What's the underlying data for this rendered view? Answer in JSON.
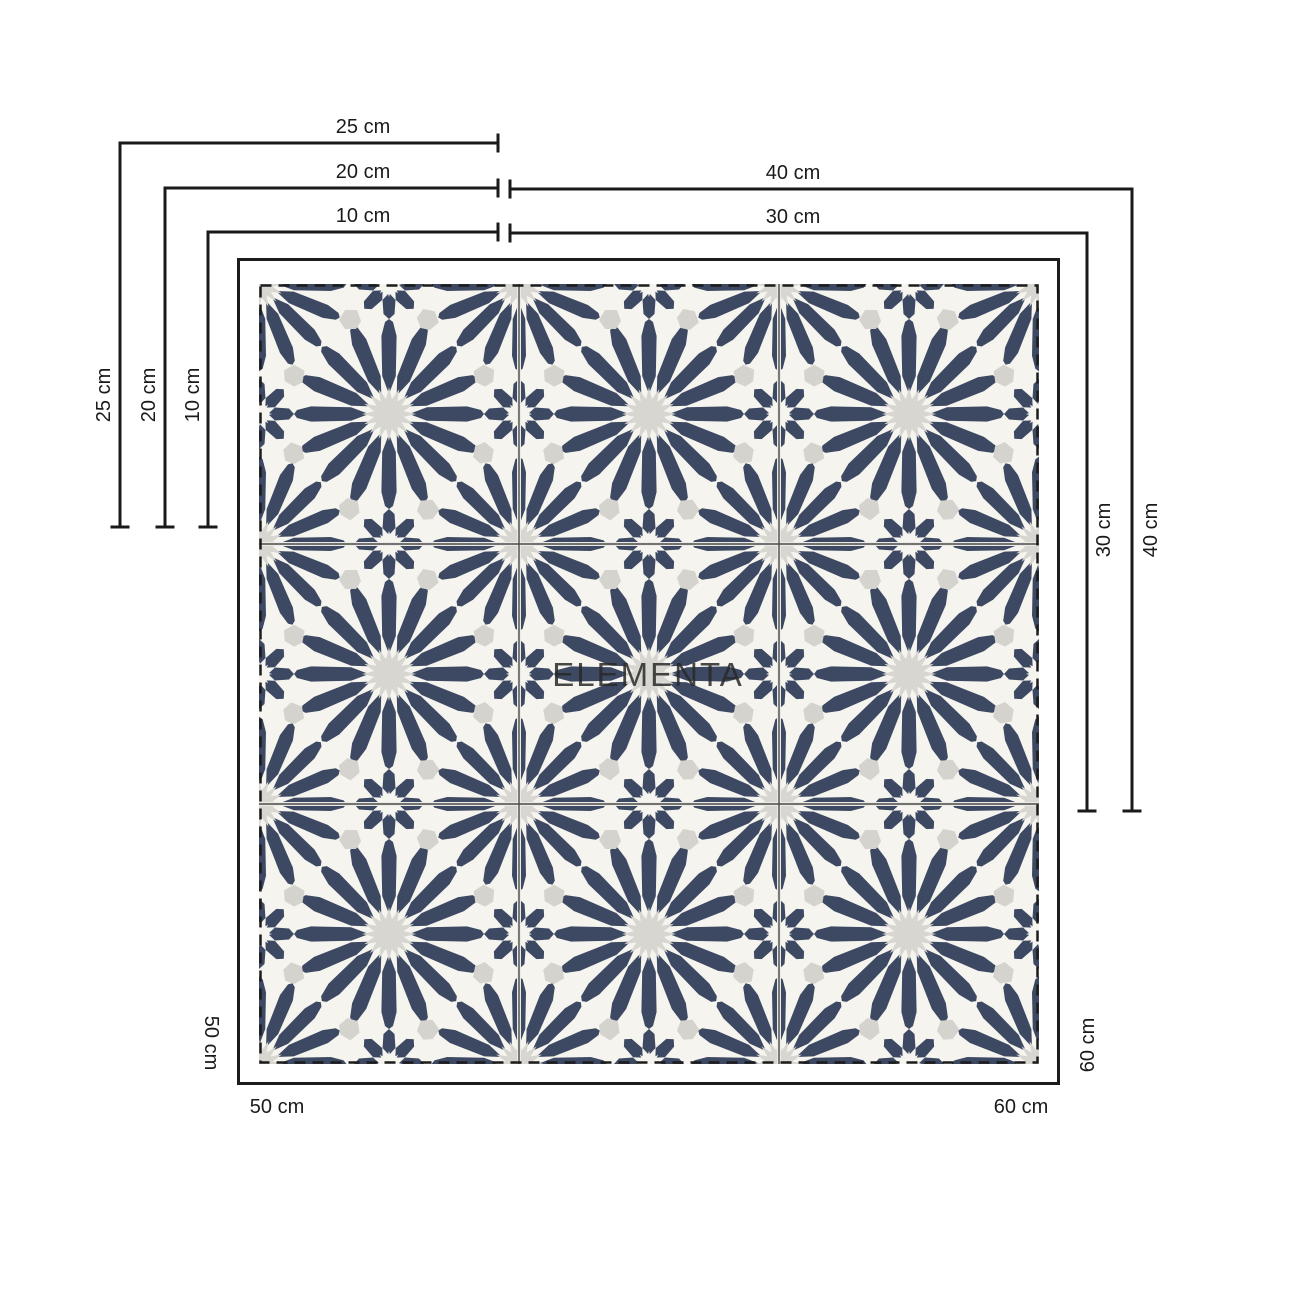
{
  "watermark": {
    "text": "ELEMENTA"
  },
  "sizes": {
    "s10": "10 cm",
    "s20": "20 cm",
    "s25": "25 cm",
    "s30": "30 cm",
    "s40": "40 cm",
    "s50": "50 cm",
    "s60": "60 cm"
  },
  "tile": {
    "grid_rows": 3,
    "grid_cols": 3,
    "colors": {
      "navy": "#3d4963",
      "background": "#f6f4ee",
      "accent_gray": "#d4d3ce",
      "core_gray": "#d7d6d0"
    }
  },
  "annotation": {
    "line_color": "#1a1a1a"
  }
}
